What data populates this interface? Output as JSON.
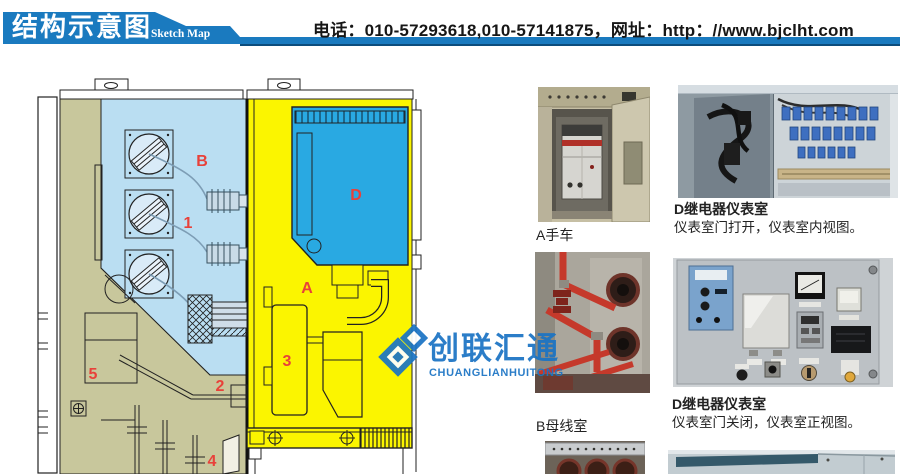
{
  "header": {
    "banner_title": "结构示意图",
    "banner_subtitle": "Sketch Map",
    "contact": "电话：010-57293618,010-57141875，网址：http：//www.bjclht.com",
    "banner_color": "#1a7abf"
  },
  "watermark": {
    "name": "创联汇通",
    "latin": "CHUANGLIANHUITONG",
    "color": "#1b74c4"
  },
  "diagram": {
    "label_color": "#e8413a",
    "region_colors": {
      "busbar_room": "#badef2",
      "instrument_room": "#29a9e2",
      "breaker_room": "#fbf500",
      "mechanism_room": "#c8c79c"
    },
    "labels": [
      {
        "id": "B"
      },
      {
        "id": "1"
      },
      {
        "id": "D"
      },
      {
        "id": "A"
      },
      {
        "id": "3"
      },
      {
        "id": "2"
      },
      {
        "id": "5"
      },
      {
        "id": "4"
      }
    ]
  },
  "photos": [
    {
      "caption": "A手车"
    },
    {
      "caption": "D继电器仪表室",
      "subcaption": "仪表室门打开，仪表室内视图。"
    },
    {
      "caption": "B母线室"
    },
    {
      "caption": "D继电器仪表室",
      "subcaption": "仪表室门关闭，仪表室正视图。"
    }
  ]
}
